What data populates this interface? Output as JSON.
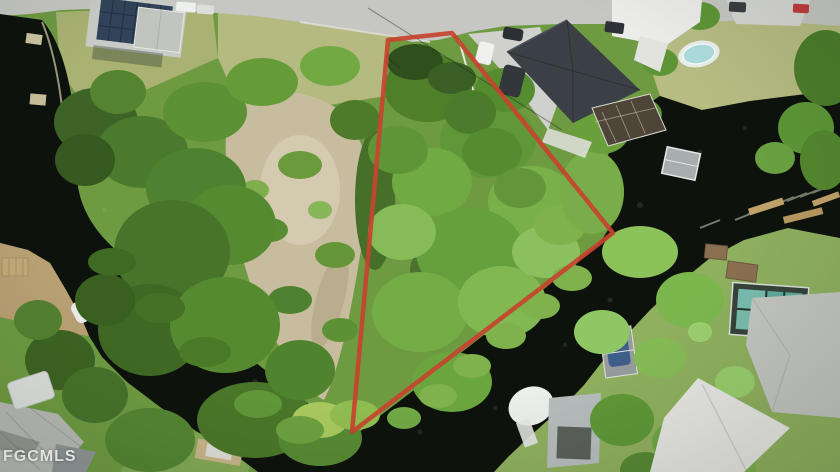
{
  "watermark": {
    "text": "FGCMLS"
  },
  "scene": {
    "kind": "aerial drone photo",
    "subject": "vacant waterfront corner lot outlined in red on a canal peninsula, surrounded by canals, docks, boats, lawns and houses",
    "elements": [
      "property-boundary-outline",
      "canal-water",
      "lot-vegetation",
      "sand-clearing",
      "street",
      "houses",
      "driveways",
      "cars",
      "docks",
      "boats",
      "swimming-pools",
      "lawns",
      "watermark"
    ]
  },
  "colors": {
    "outline-red": "#c7432f",
    "water-dark": "#0d120c",
    "canopy-green": "#5f9636",
    "lawn-green": "#a9b273",
    "sand-tan": "#c8bc9f",
    "road-gray": "#c6c7c3",
    "roof-charcoal": "#3b4046",
    "roof-light": "#e7e7e3",
    "pool-teal": "#5ea99b",
    "pool-blue": "#aadadc",
    "watermark-white": "#ffffff"
  }
}
